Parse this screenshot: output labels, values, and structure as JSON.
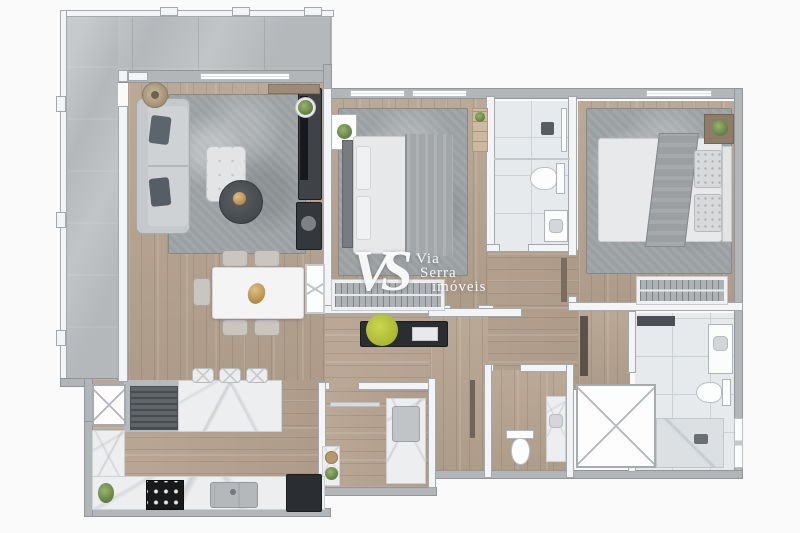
{
  "watermark": {
    "monogram": "VS",
    "brand_line1": "Via",
    "brand_line2": "Serra",
    "brand_line3": "imóveis"
  },
  "palette": {
    "bg": "#fafafa",
    "wood": "#b7a491",
    "marble_balcony": "#b4b8bb",
    "counter_marble": "#eceef0",
    "rug": "#9ba0a3",
    "wall_interior": "#f3f4f5",
    "wall_exterior": "#b2b6b9",
    "tile": "#e7eaec",
    "sofa": "#c6c9cc",
    "dark_furniture": "#2a2d31",
    "accent_gold": "#a5762f",
    "plant_green": "#5f7d42",
    "plant_lime": "#aab92f"
  }
}
